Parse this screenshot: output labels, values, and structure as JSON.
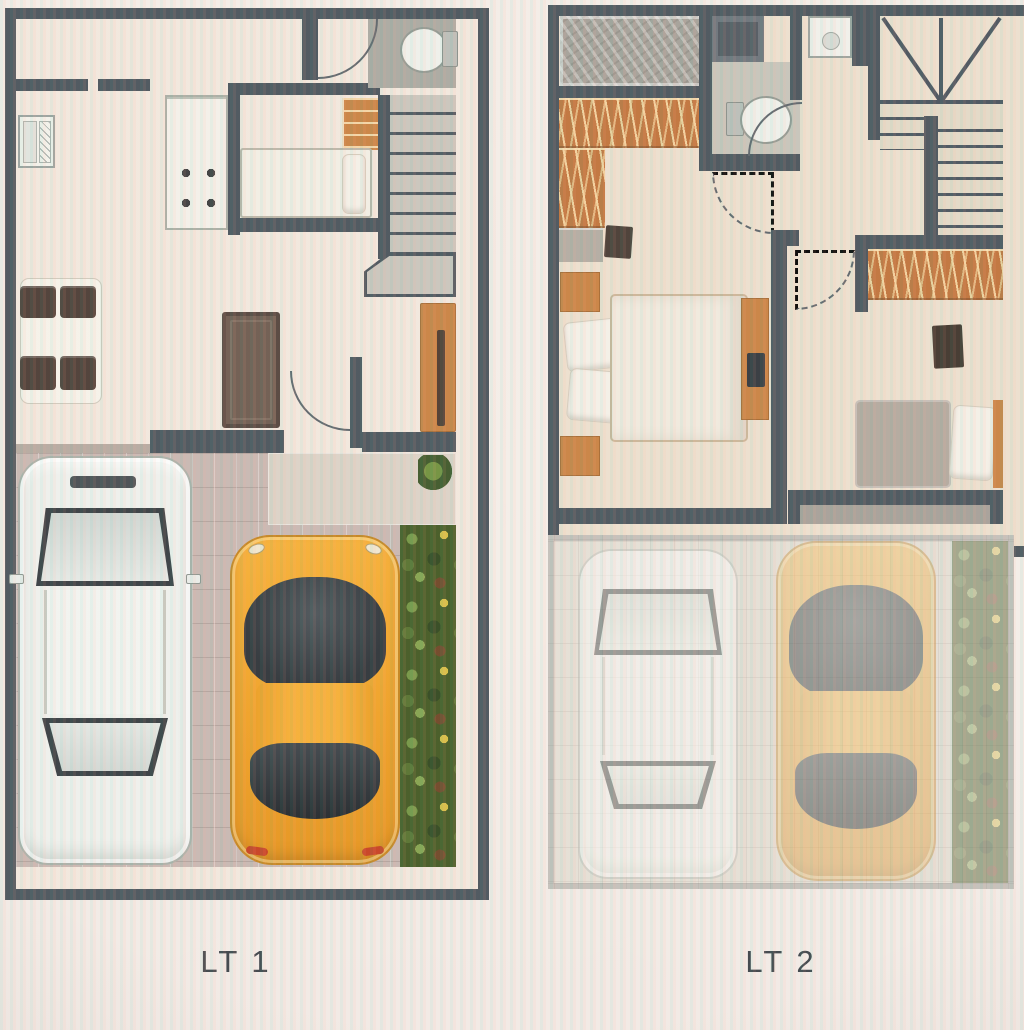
{
  "plans": [
    {
      "label": "LT 1",
      "floor_elements": [
        "kitchen-counter-wall",
        "kitchen-sink",
        "stove-4-burners",
        "small-room-single-bed",
        "open-shelf",
        "bathroom-toilet",
        "staircase",
        "dining-table-4-chairs",
        "sofa",
        "tall-wood-cabinet",
        "entry-door-arc",
        "driveway-pavers",
        "patio-slab",
        "white-car-top-view",
        "yellow-sports-car-top-view",
        "garden-strip",
        "shrub"
      ]
    },
    {
      "label": "LT 2",
      "floor_elements": [
        "textured-balcony",
        "walk-in-closet-hangers",
        "bathroom-toilet",
        "shower",
        "wash-basin",
        "switchback-staircase",
        "bedroom1-double-bed",
        "nightstands",
        "pillows",
        "tv-console",
        "wall-tv",
        "bedroom2-bed",
        "bedroom2-closet-hangers",
        "terrace-ledge",
        "faded-driveway",
        "faded-white-car",
        "faded-yellow-car",
        "faded-garden-strip"
      ]
    }
  ],
  "palette": {
    "wall": "#485159",
    "floor_lt1": "#f2e7dc",
    "floor_lt2": "#ecdfcd",
    "wood": "#c8803f",
    "closet_orange": "#bf7138",
    "stairs": "#c9c4bb",
    "pavers": "#c7b6b0",
    "patio": "#dbd1c5",
    "plants_dark": "#41571f",
    "plants_light": "#729441",
    "car_white": "#eef0ec",
    "car_yellow": "#f3a62a",
    "glass_dark": "#343a3e",
    "sofa": "#6b584c",
    "terrace": "#a59e96",
    "label_color": "#3a4046"
  }
}
